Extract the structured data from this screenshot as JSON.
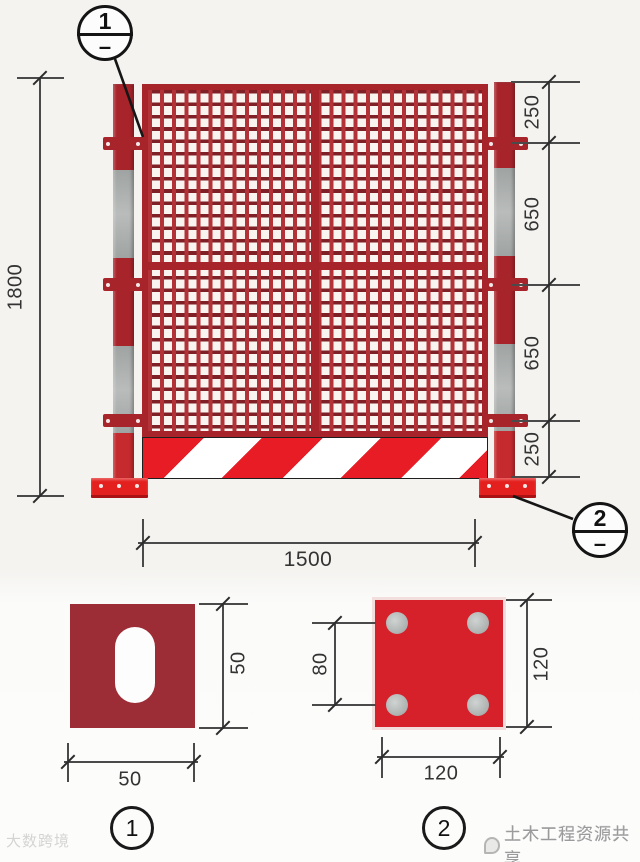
{
  "colors": {
    "fence_red": "#a8242b",
    "bright_red": "#e4201f",
    "stripe_red": "#e81c24",
    "mesh_line_vertical": "#b23237",
    "mesh_line_horizontal": "#7e2025",
    "post_silver": "#a9acab",
    "detail1_plate": "#9c2c35",
    "detail2_plate": "#d6202a",
    "dim_line": "#4a4a4a"
  },
  "elevation": {
    "height_dim": "1800",
    "right_dims": [
      "250",
      "650",
      "650",
      "250"
    ],
    "width_dim": "1500",
    "callouts": {
      "c1": {
        "num": "1",
        "dash": "–"
      },
      "c2": {
        "num": "2",
        "dash": "–"
      }
    }
  },
  "details": {
    "d1": {
      "label": "1",
      "height_dim": "50",
      "width_dim": "50"
    },
    "d2": {
      "label": "2",
      "hole_spacing_dim": "80",
      "height_dim": "120",
      "width_dim": "120"
    }
  },
  "watermarks": {
    "left": "大数跨境",
    "right": "土木工程资源共享"
  }
}
